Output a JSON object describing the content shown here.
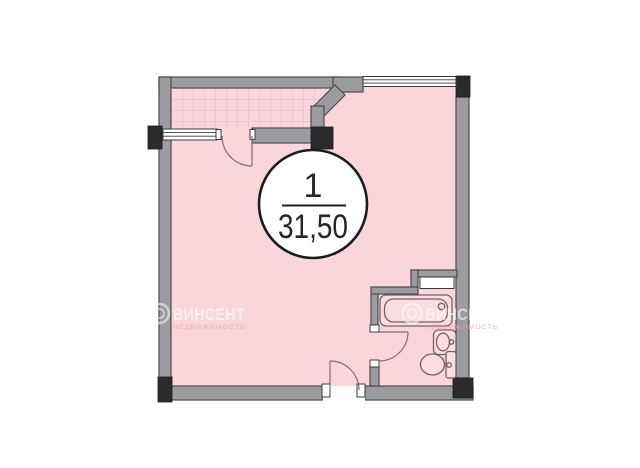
{
  "unit_badge": {
    "number": "1",
    "area": "31,50"
  },
  "watermark": {
    "brand": "ВИНСЕНТ",
    "tagline": "НЕДВИЖИМОСТЬ"
  },
  "symbols": [
    "balcony-window",
    "balcony-door",
    "top-window",
    "entrance-door",
    "bathroom-door",
    "bathtub",
    "sink",
    "toilet",
    "ventilation-shaft",
    "structural-column"
  ],
  "colors": {
    "floor_pink": "#FAD6DA",
    "hatch_line": "#D8B9C1",
    "wall_gray": "#9B9BA0",
    "wall_outline": "#4B4B50",
    "column_black": "#2B2B2E",
    "fixture_line": "#6F6368",
    "door_line": "#7D6E74",
    "badge_outline": "#1C1C1F",
    "badge_text": "#26262A",
    "wm_text": "#FFFFFF",
    "wm_tagline": "#DFA8B1"
  }
}
